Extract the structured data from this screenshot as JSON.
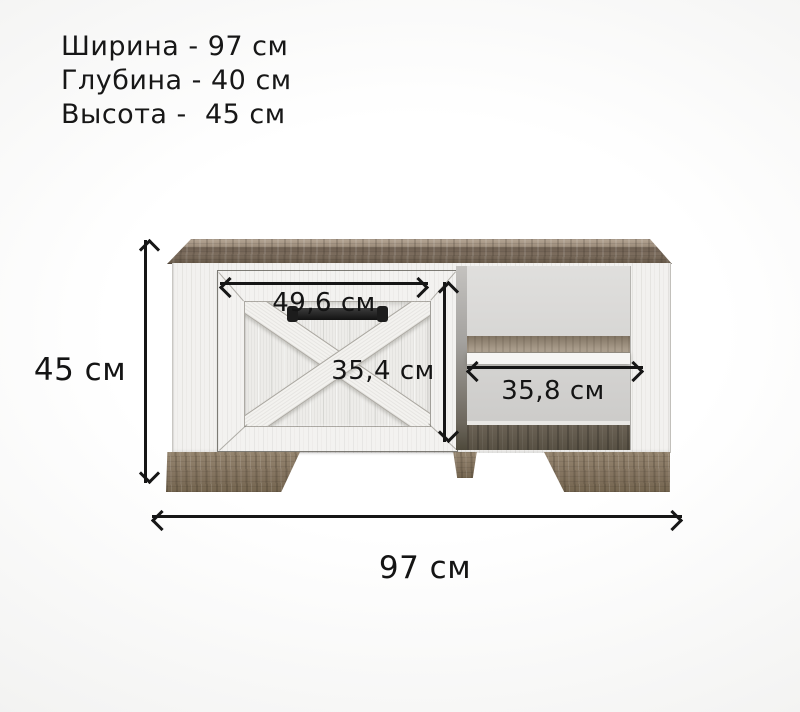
{
  "specs": {
    "width_line": "Ширина - 97 см",
    "depth_line": "Глубина - 40 см",
    "height_line": "Высота -  45 см"
  },
  "dimension_labels": {
    "overall_height": "45 см",
    "overall_width": "97 см",
    "door_width": "49,6 см",
    "door_height": "35,4 см",
    "niche_width": "35,8 см"
  },
  "colors": {
    "background": "#f2f2f1",
    "wood_top_light": "#a99a89",
    "wood_top_dark": "#716253",
    "body_white": "#f2f1ef",
    "niche_gray": "#d6d5d3",
    "shelf_wood": "#9a8d7c",
    "feet_wood": "#8b7b67",
    "handle_black": "#1f1f1f",
    "dimension_ink": "#161616"
  }
}
